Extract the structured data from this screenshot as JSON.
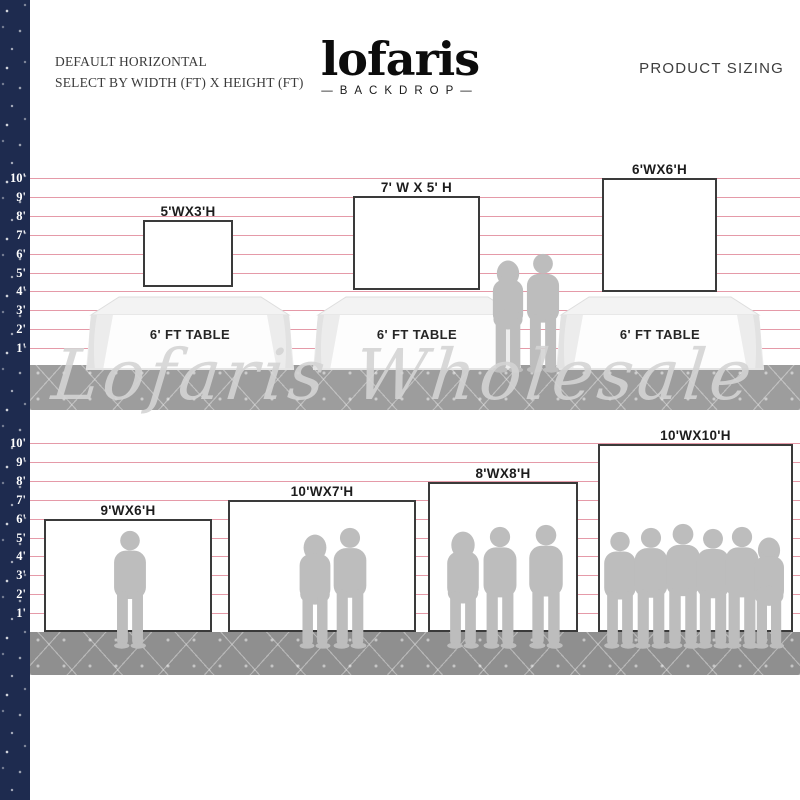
{
  "header": {
    "left_line1": "DEFAULT HORIZONTAL",
    "left_line2": "SELECT BY WIDTH (FT) X HEIGHT (FT)",
    "logo_text": "lofaris",
    "logo_sub": "—BACKDROP—",
    "right_text": "PRODUCT SIZING"
  },
  "watermark": "Lofaris Wholesale",
  "ruler_feet": [
    "10'",
    "9'",
    "8'",
    "7'",
    "6'",
    "5'",
    "4'",
    "3'",
    "2'",
    "1'"
  ],
  "colors": {
    "navy": "#1e2b4f",
    "line_pink": "#e59aa8",
    "band_gray": "#9d9d9d",
    "ground_gray": "#8f8f8f",
    "silhouette": "#bdbdbd",
    "backdrop_border": "#3a3a3a"
  },
  "top_section": {
    "table_label": "6' FT TABLE",
    "table_count": 3,
    "backdrops": [
      {
        "label": "5'WX3'H",
        "width_ft": 5,
        "height_ft": 3
      },
      {
        "label": "7' W X 5' H",
        "width_ft": 7,
        "height_ft": 5
      },
      {
        "label": "6'WX6'H",
        "width_ft": 6,
        "height_ft": 6
      }
    ]
  },
  "bottom_section": {
    "backdrops": [
      {
        "label": "9'WX6'H",
        "width_ft": 9,
        "height_ft": 6,
        "people": 1
      },
      {
        "label": "10'WX7'H",
        "width_ft": 10,
        "height_ft": 7,
        "people": 2
      },
      {
        "label": "8'WX8'H",
        "width_ft": 8,
        "height_ft": 8,
        "people": 3
      },
      {
        "label": "10'WX10'H",
        "width_ft": 10,
        "height_ft": 10,
        "people": 6
      }
    ]
  }
}
